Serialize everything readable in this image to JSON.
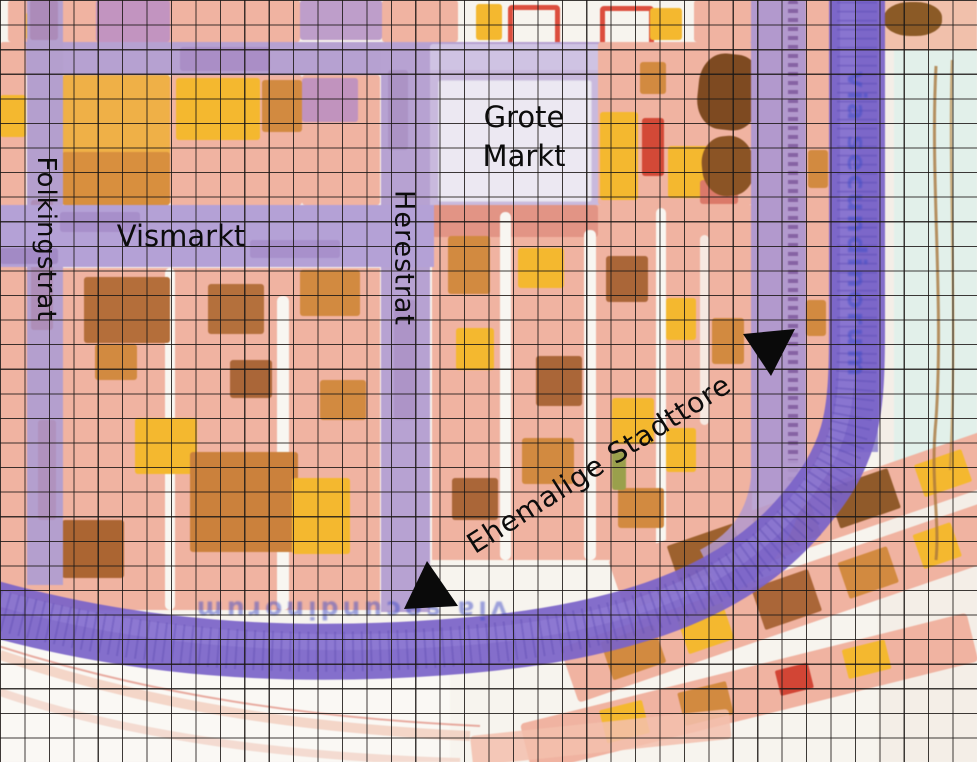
{
  "map": {
    "street_labels": {
      "grote_markt": {
        "line1": "Grote",
        "line2": "Markt"
      },
      "vismarkt": "Vismarkt",
      "folkingstrat": "Folkingstrat",
      "herestrat": "Herestrat"
    },
    "annotation": {
      "ehemalige_stadttore": "Ehemalige Stadttore"
    },
    "faint_map_text": {
      "right_band": "via secundinorum",
      "bottom_band": "via secundinorum"
    },
    "markers": [
      {
        "name": "former-gate-arrow-east",
        "shape": "filled-triangle",
        "direction": "down",
        "approx_position": {
          "x": 769,
          "y": 352
        }
      },
      {
        "name": "former-gate-arrow-south",
        "shape": "filled-triangle",
        "direction": "up",
        "approx_position": {
          "x": 429,
          "y": 585
        }
      }
    ],
    "palette": {
      "block_salmon": "#efb3a2",
      "building_orange": "#d08a42",
      "building_yellow": "#f2b833",
      "building_brown": "#a8663a",
      "street_purple": "#b6a1d0",
      "ring_indigo": "#7a63c5",
      "canal_blue_band": "#9c93cf",
      "pale_cyan": "#e2f0ea",
      "grid_line": "#1e1a18",
      "label_black": "#0d0d0d",
      "faint_text_blue": "#404cc3"
    },
    "grid": {
      "columns": 40,
      "rows": 31
    }
  }
}
